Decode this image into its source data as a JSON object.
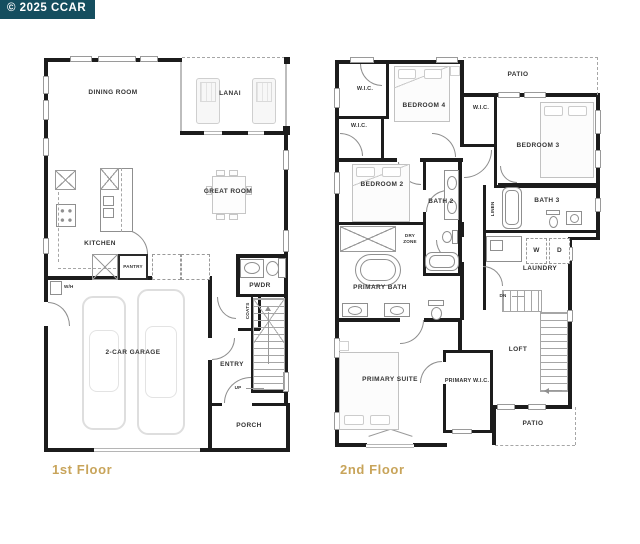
{
  "badge": {
    "text": "© 2025 CCAR"
  },
  "f1": {
    "title": "1st Floor",
    "dining": "DINING ROOM",
    "lanai": "LANAI",
    "great": "GREAT ROOM",
    "kitchen": "KITCHEN",
    "pantry": "PANTRY",
    "pwdr": "PWDR",
    "coats": "COATS",
    "wh": "W/H",
    "garage": "2-CAR GARAGE",
    "entry": "ENTRY",
    "up": "UP",
    "porch": "PORCH"
  },
  "f2": {
    "title": "2nd Floor",
    "wic1": "W.I.C.",
    "wic2": "W.I.C.",
    "wic3": "W.I.C.",
    "bedroom4": "BEDROOM 4",
    "patio_top": "PATIO",
    "bedroom3": "BEDROOM 3",
    "bedroom2": "BEDROOM 2",
    "bath2": "BATH 2",
    "dry_zone": "DRY ZONE",
    "primary_bath": "PRIMARY BATH",
    "linen": "LINEN",
    "bath3": "BATH 3",
    "washer": "W",
    "dryer": "D",
    "laundry": "LAUNDRY",
    "dn": "DN",
    "loft": "LOFT",
    "primary_suite": "PRIMARY SUITE",
    "primary_wic": "PRIMARY W.I.C.",
    "patio_bottom": "PATIO"
  },
  "colors": {
    "badge_bg": "#154e5f",
    "badge_fg": "#ffffff",
    "wall": "#1c1c1c",
    "floor_label": "#c8a45a",
    "furniture": "#c6c6c6"
  }
}
